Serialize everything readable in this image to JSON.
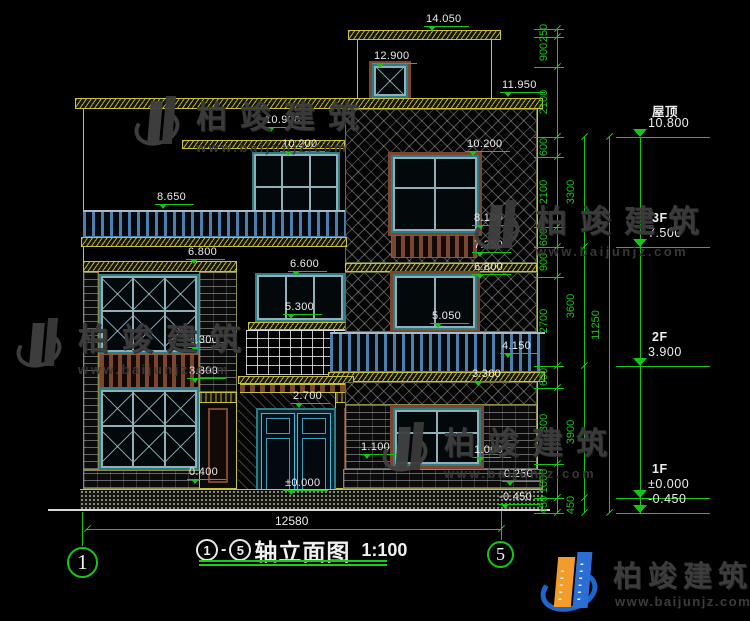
{
  "watermark": {
    "brand": "柏竣建筑",
    "url": "www.baijunjz.com"
  },
  "footer": {
    "brand": "柏竣建筑",
    "url": "www.baijunjz.com"
  },
  "title_block": {
    "axis_from": "1",
    "separator": "-",
    "axis_to": "5",
    "title": "轴立面图",
    "scale": "1:100"
  },
  "bottom_dim": "12580",
  "axis_bubbles": [
    {
      "label": "1"
    },
    {
      "label": "5"
    }
  ],
  "right_levels": [
    {
      "name": "屋顶",
      "value": "10.800",
      "y": 137
    },
    {
      "name": "3F",
      "value": "7.500",
      "y": 247
    },
    {
      "name": "2F",
      "value": "3.900",
      "y": 366
    },
    {
      "name": "1F",
      "value": "±0.000",
      "y": 498
    },
    {
      "name": "",
      "value": "-0.450",
      "y": 513
    }
  ],
  "dim_chains": [
    {
      "x": 557,
      "ticks": [
        29,
        37,
        67,
        137,
        157,
        227,
        247,
        277,
        366,
        388,
        464,
        498,
        513
      ],
      "labels": [
        {
          "t": "250",
          "y": 33
        },
        {
          "t": "900",
          "y": 52
        },
        {
          "t": "2100",
          "y": 102
        },
        {
          "t": "600",
          "y": 147
        },
        {
          "t": "2100",
          "y": 192
        },
        {
          "t": "600",
          "y": 237
        },
        {
          "t": "900",
          "y": 262
        },
        {
          "t": "2700",
          "y": 321
        },
        {
          "t": "600",
          "y": 377
        },
        {
          "t": "2300",
          "y": 426
        },
        {
          "t": "1000",
          "y": 481
        },
        {
          "t": "450",
          "y": 505
        }
      ]
    },
    {
      "x": 584,
      "ticks": [
        137,
        247,
        366,
        498,
        513
      ],
      "labels": [
        {
          "t": "3300",
          "y": 192
        },
        {
          "t": "3600",
          "y": 306
        },
        {
          "t": "3900",
          "y": 432
        },
        {
          "t": "450",
          "y": 505
        }
      ]
    },
    {
      "x": 609,
      "ticks": [
        137,
        513
      ],
      "labels": [
        {
          "t": "11250",
          "y": 325
        }
      ]
    }
  ],
  "spot_levels": [
    {
      "v": "14.050",
      "x": 424,
      "y": 13
    },
    {
      "v": "12.900",
      "x": 372,
      "y": 50
    },
    {
      "v": "11.950",
      "x": 500,
      "y": 79
    },
    {
      "v": "10.900",
      "x": 263,
      "y": 114
    },
    {
      "v": "10.200",
      "x": 280,
      "y": 138
    },
    {
      "v": "10.200",
      "x": 465,
      "y": 138
    },
    {
      "v": "8.650",
      "x": 155,
      "y": 191
    },
    {
      "v": "8.100",
      "x": 472,
      "y": 212
    },
    {
      "v": "7.250",
      "x": 472,
      "y": 239
    },
    {
      "v": "6.800",
      "x": 472,
      "y": 261
    },
    {
      "v": "6.800",
      "x": 186,
      "y": 246
    },
    {
      "v": "6.600",
      "x": 288,
      "y": 258
    },
    {
      "v": "5.300",
      "x": 283,
      "y": 301
    },
    {
      "v": "5.050",
      "x": 430,
      "y": 310
    },
    {
      "v": "4.300",
      "x": 187,
      "y": 334
    },
    {
      "v": "3.300",
      "x": 187,
      "y": 365
    },
    {
      "v": "4.150",
      "x": 500,
      "y": 340
    },
    {
      "v": "3.300",
      "x": 470,
      "y": 368
    },
    {
      "v": "2.700",
      "x": 291,
      "y": 390
    },
    {
      "v": "1.100",
      "x": 359,
      "y": 441
    },
    {
      "v": "1.000",
      "x": 472,
      "y": 444
    },
    {
      "v": "0.400",
      "x": 187,
      "y": 466
    },
    {
      "v": "±0.000",
      "x": 283,
      "y": 477
    },
    {
      "v": "0.250",
      "x": 502,
      "y": 468
    },
    {
      "v": "-0.450",
      "x": 497,
      "y": 491
    }
  ],
  "watermarks": [
    {
      "x": 134,
      "y": 92
    },
    {
      "x": 474,
      "y": 196
    },
    {
      "x": 16,
      "y": 314
    },
    {
      "x": 382,
      "y": 418
    }
  ]
}
